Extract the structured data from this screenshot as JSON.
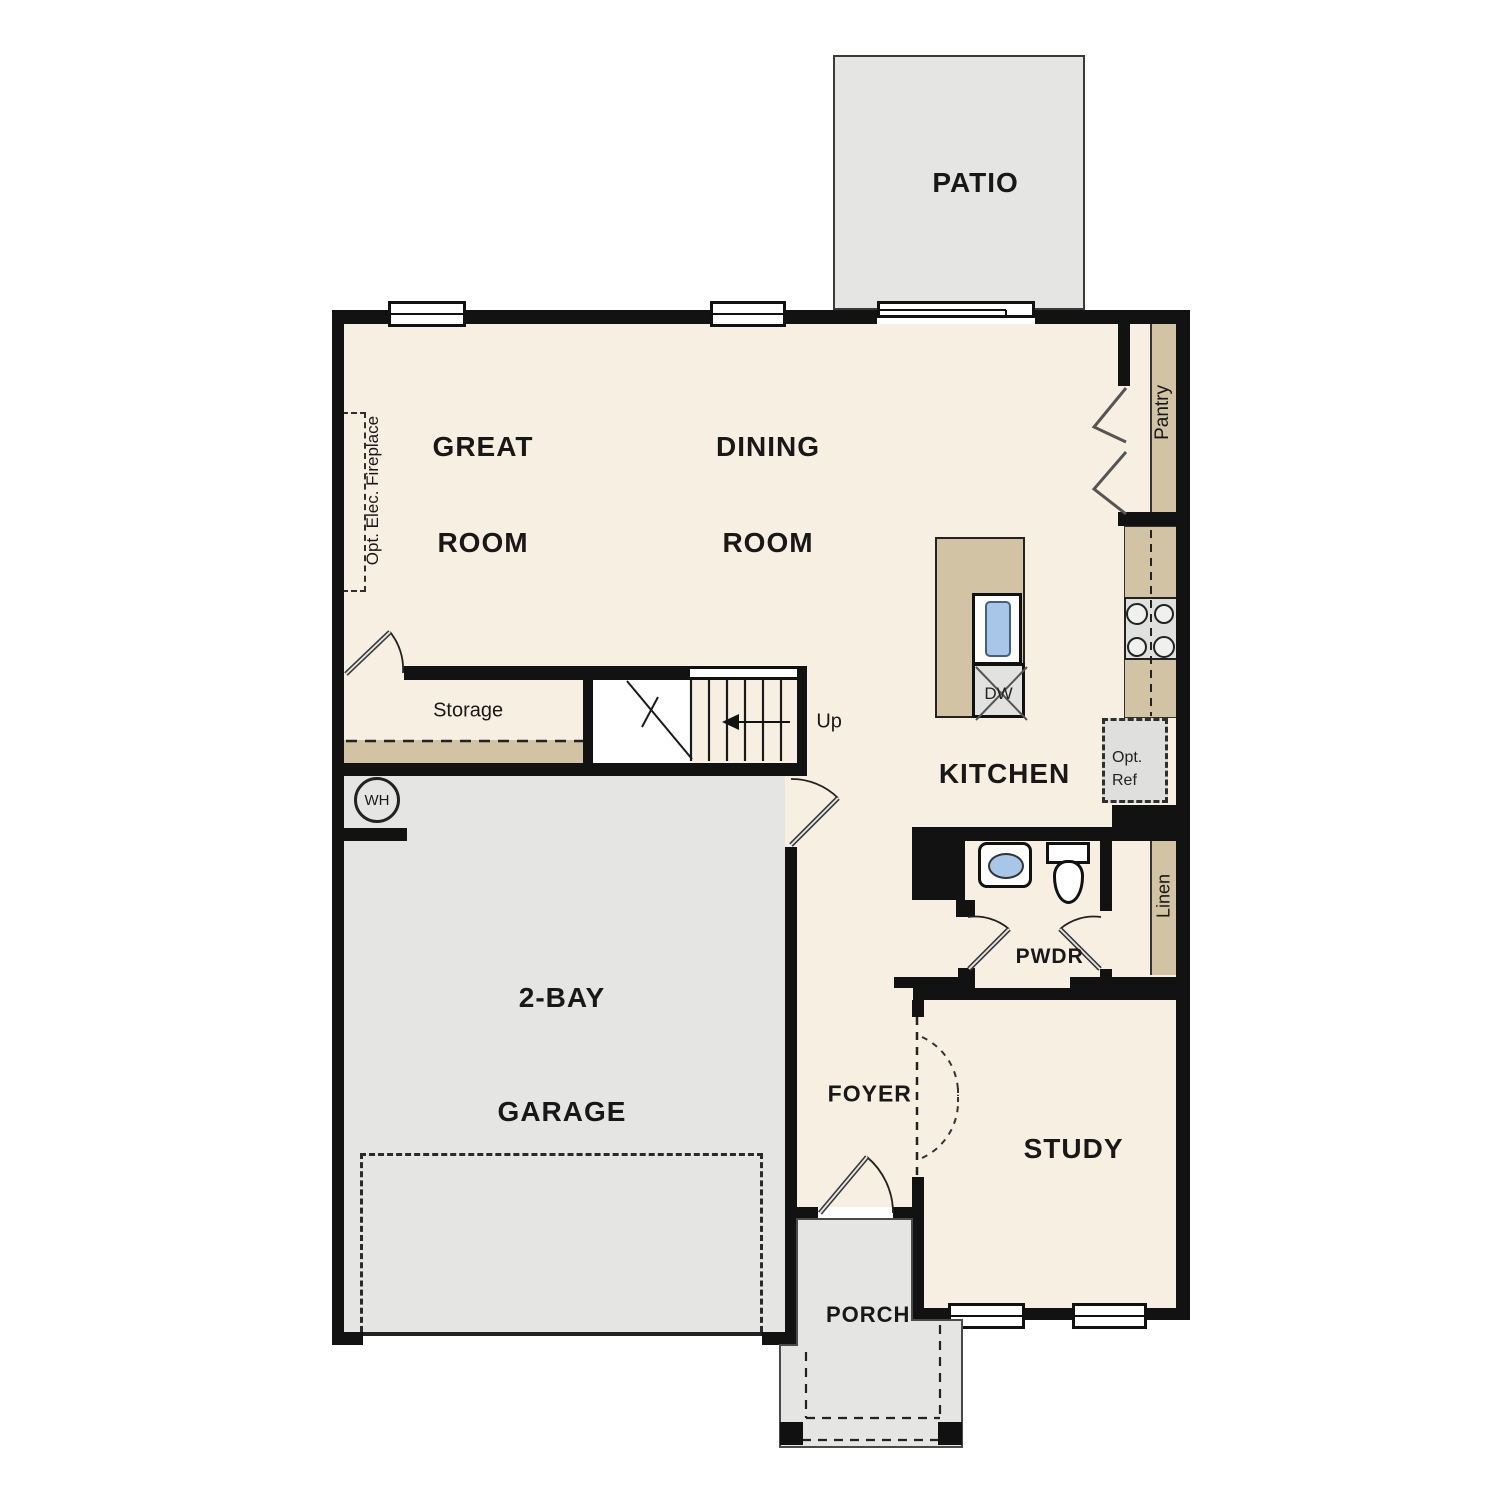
{
  "colors": {
    "floor_cream": "#f7efe1",
    "surface_tan": "#d2c3a5",
    "exterior_gray": "#e5e5e3",
    "wall_black": "#121212",
    "sink_blue": "#a7c6e8"
  },
  "room_labels": {
    "patio": "PATIO",
    "great_room": [
      "GREAT",
      "ROOM"
    ],
    "dining_room": [
      "DINING",
      "ROOM"
    ],
    "kitchen": "KITCHEN",
    "garage": [
      "2-BAY",
      "GARAGE"
    ],
    "foyer": "FOYER",
    "study": "STUDY",
    "porch": "PORCH",
    "powder": "PWDR"
  },
  "feature_labels": {
    "storage": "Storage",
    "pantry": "Pantry",
    "linen": "Linen",
    "stairs_up": "Up",
    "water_heater": "WH",
    "dishwasher": "DW",
    "opt_ref": [
      "Opt.",
      "Ref"
    ],
    "opt_fireplace": "Opt. Elec. Fireplace"
  }
}
